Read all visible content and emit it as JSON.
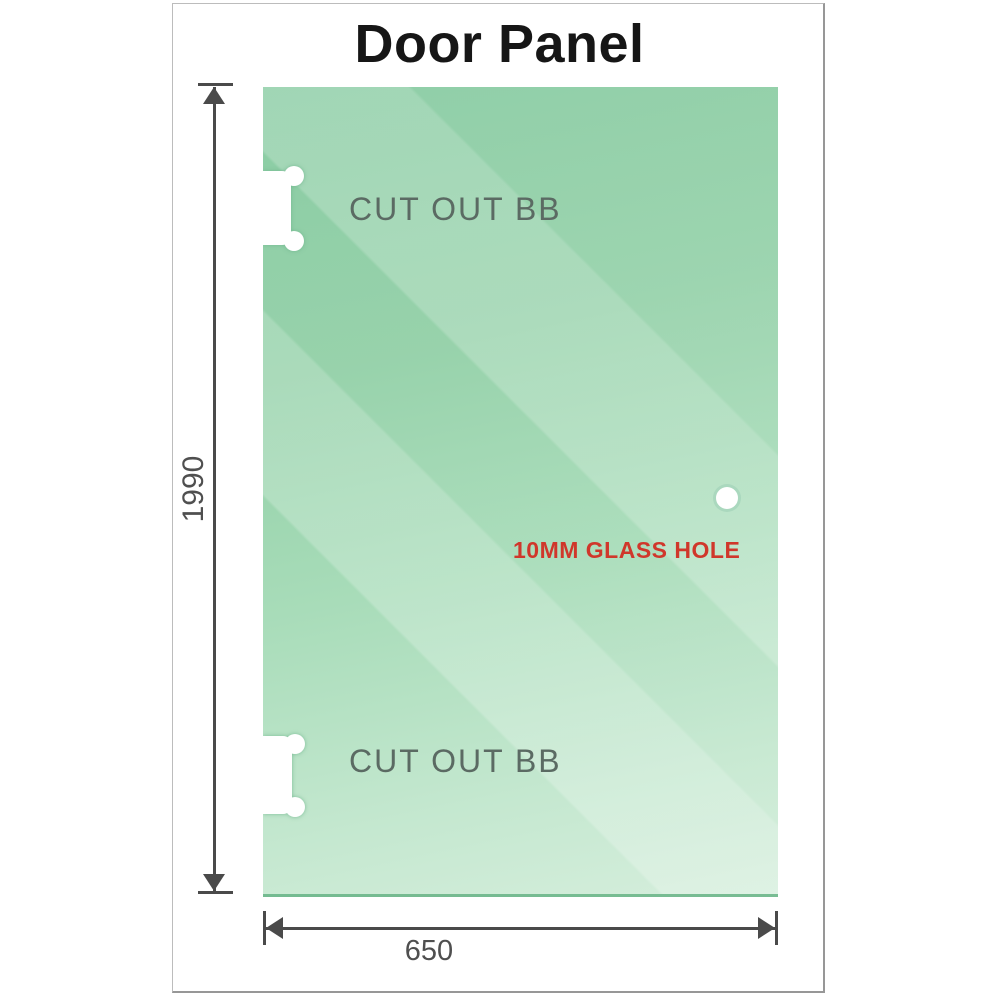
{
  "title": "Door Panel",
  "panel": {
    "cutout_top": {
      "label": "CUT OUT BB"
    },
    "cutout_bottom": {
      "label": "CUT OUT BB"
    },
    "glass_hole": {
      "label": "10MM GLASS HOLE"
    },
    "colors": {
      "glass_top": "#83c99e",
      "glass_bottom": "#d5eedc",
      "cutout_label": "#5b6a63",
      "glass_hole_label": "#d0372b"
    }
  },
  "dimensions": {
    "height_mm": "1990",
    "width_mm": "650",
    "line_color": "#4a4a4a",
    "text_color": "#4f4f4f"
  },
  "frame": {
    "border_color": "#bcbcbc"
  }
}
